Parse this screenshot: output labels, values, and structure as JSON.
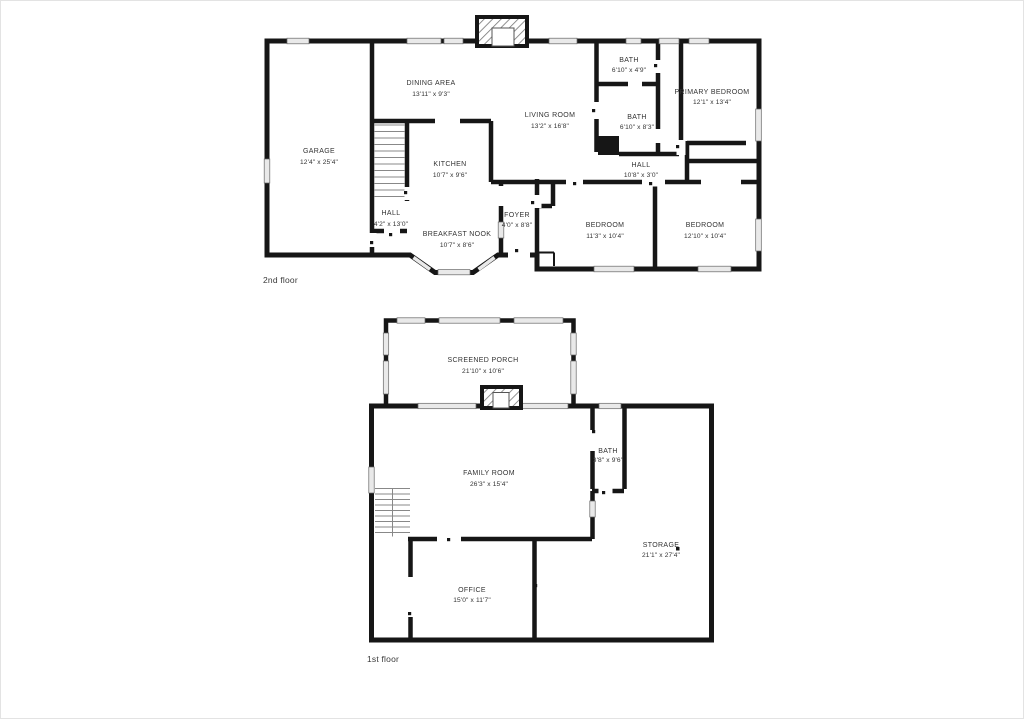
{
  "floors": [
    {
      "label": "2nd floor",
      "rooms": [
        {
          "name": "GARAGE",
          "dims": "12'4\" x 25'4\""
        },
        {
          "name": "DINING AREA",
          "dims": "13'11\" x 9'3\""
        },
        {
          "name": "KITCHEN",
          "dims": "10'7\" x 9'6\""
        },
        {
          "name": "HALL",
          "dims": "4'2\" x 13'0\""
        },
        {
          "name": "BREAKFAST NOOK",
          "dims": "10'7\" x 8'6\""
        },
        {
          "name": "FOYER",
          "dims": "4'0\" x 8'8\""
        },
        {
          "name": "LIVING ROOM",
          "dims": "13'2\" x 16'8\""
        },
        {
          "name": "BATH",
          "dims": "6'10\" x 4'9\""
        },
        {
          "name": "BATH",
          "dims": "6'10\" x 8'3\""
        },
        {
          "name": "HALL",
          "dims": "10'8\" x 3'0\""
        },
        {
          "name": "PRIMARY BEDROOM",
          "dims": "12'1\" x 13'4\""
        },
        {
          "name": "BEDROOM",
          "dims": "11'3\" x 10'4\""
        },
        {
          "name": "BEDROOM",
          "dims": "12'10\" x 10'4\""
        }
      ]
    },
    {
      "label": "1st floor",
      "rooms": [
        {
          "name": "SCREENED PORCH",
          "dims": "21'10\" x 10'6\""
        },
        {
          "name": "FAMILY ROOM",
          "dims": "26'3\" x 15'4\""
        },
        {
          "name": "BATH",
          "dims": "3'8\" x 9'6\""
        },
        {
          "name": "STORAGE",
          "dims": "21'1\" x 27'4\""
        },
        {
          "name": "OFFICE",
          "dims": "15'0\" x 11'7\""
        }
      ]
    }
  ],
  "colors": {
    "wall": "#161616",
    "window_fill": "#e9e9e9",
    "window_stroke": "#666666",
    "label_text": "#333333"
  }
}
